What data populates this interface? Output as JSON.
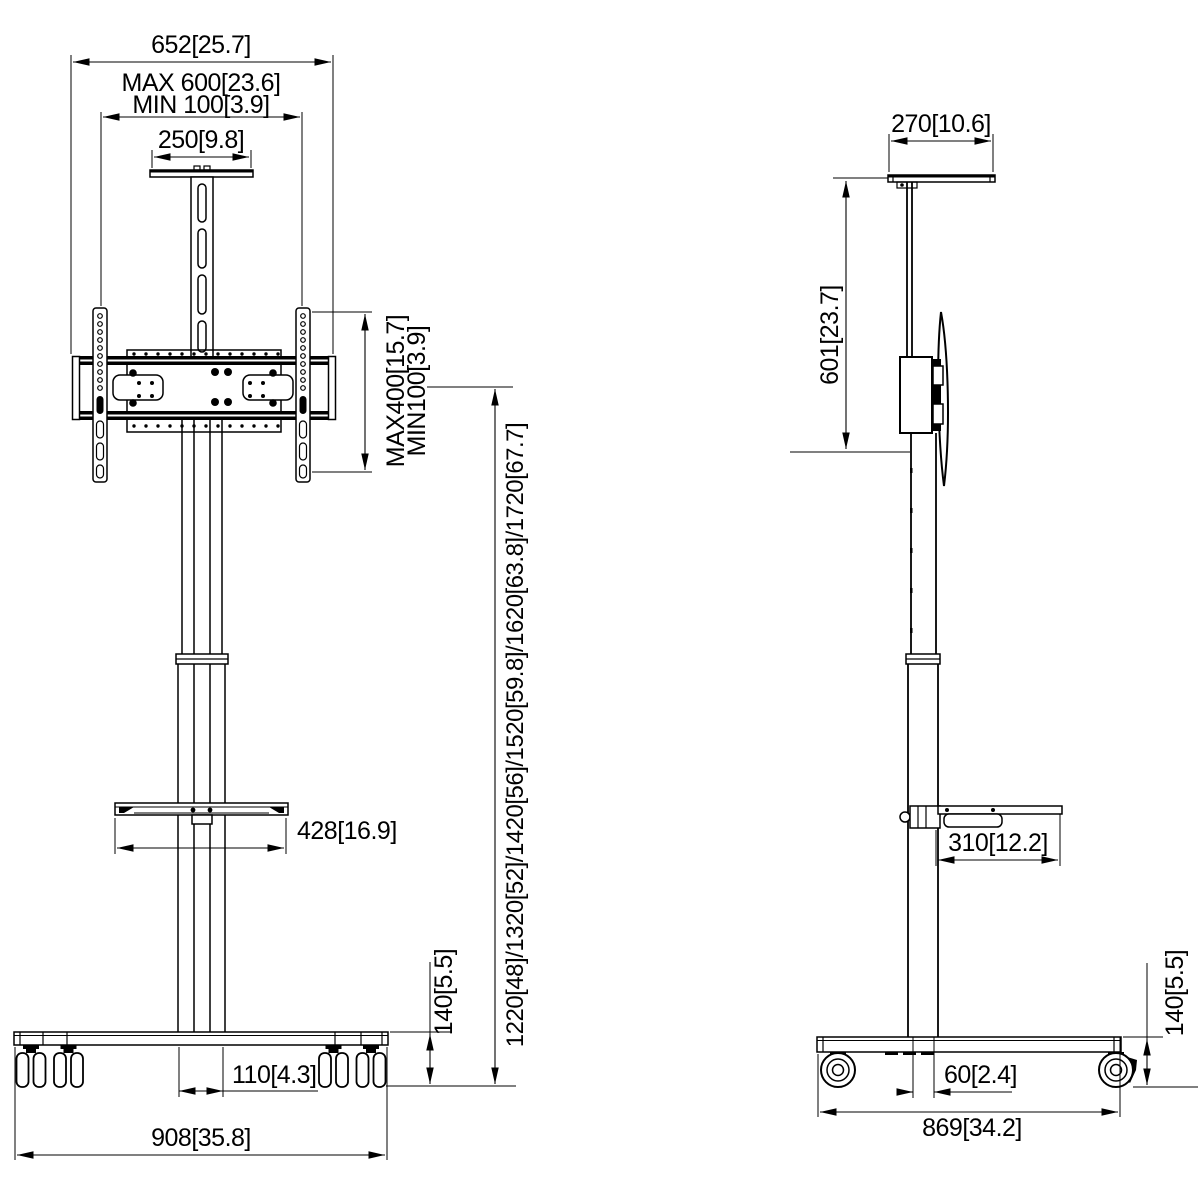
{
  "title": "TV floor stand dimensional drawing",
  "front": {
    "total_width": "652[25.7]",
    "vesa_width_max": "MAX 600[23.6]",
    "vesa_width_min": "MIN 100[3.9]",
    "camera_plate_width": "250[9.8]",
    "vesa_height_max": "MAX400[15.7]",
    "vesa_height_min": "MIN100[3.9]",
    "screen_center_heights": "1220[48]/1320[52]/1420[56]/1520[59.8]/1620[63.8]/1720[67.7]",
    "shelf_width": "428[16.9]",
    "column_width": "110[4.3]",
    "base_width": "908[35.8]",
    "base_height": "140[5.5]"
  },
  "side": {
    "top_shelf_depth": "270[10.6]",
    "top_to_mount_drop": "601[23.7]",
    "shelf_depth": "310[12.2]",
    "column_offset": "60[2.4]",
    "base_depth": "869[34.2]",
    "base_height": "140[5.5]"
  },
  "colors": {
    "line": "#000000",
    "background": "#ffffff"
  }
}
